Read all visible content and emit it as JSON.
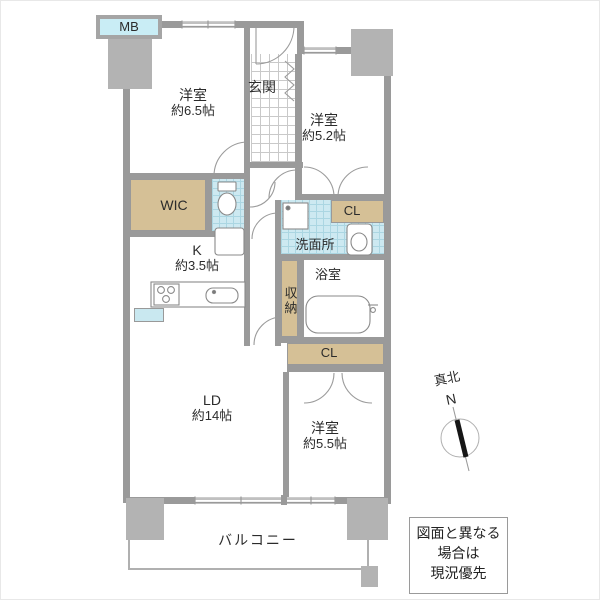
{
  "floorplan": {
    "mb_label": "MB",
    "rooms": {
      "bedroom_65": {
        "name": "洋室",
        "size": "約6.5帖"
      },
      "entrance": {
        "name": "玄関"
      },
      "bedroom_52": {
        "name": "洋室",
        "size": "約5.2帖"
      },
      "wic": {
        "name": "WIC"
      },
      "kitchen": {
        "name": "K",
        "size": "約3.5帖"
      },
      "washroom": {
        "name": "洗面所"
      },
      "closet_upper": {
        "name": "CL"
      },
      "bathroom": {
        "name": "浴室"
      },
      "storage": {
        "name": "収納"
      },
      "closet_lower": {
        "name": "CL"
      },
      "living_dining": {
        "name": "LD",
        "size": "約14帖"
      },
      "bedroom_55": {
        "name": "洋室",
        "size": "約5.5帖"
      },
      "balcony": {
        "name": "バルコニー"
      }
    },
    "compass": {
      "label": "真北",
      "letter": "N"
    },
    "disclaimer": {
      "line1": "図面と異なる",
      "line2": "場合は",
      "line3": "現況優先"
    },
    "colors": {
      "wall": "#9a9a9a",
      "pillar": "#b3b3b3",
      "closet_tan": "#d5c096",
      "tile_blue": "#cde9f1",
      "mb_fill": "#c9edf5"
    }
  }
}
